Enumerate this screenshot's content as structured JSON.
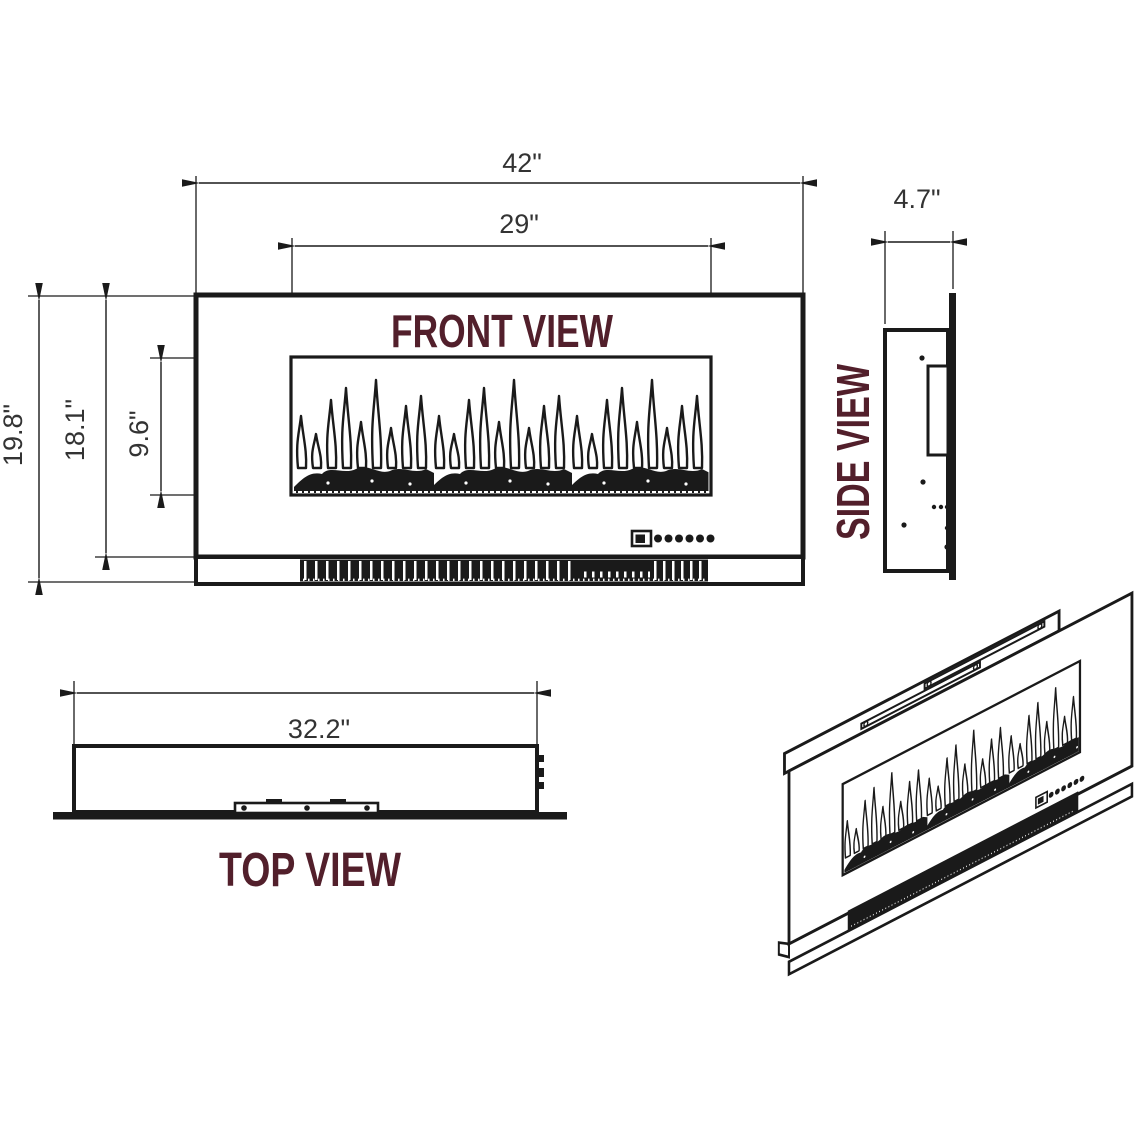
{
  "colors": {
    "title": "#521f2b",
    "line": "#1a1a1a",
    "dim_text": "#333333",
    "background": "#ffffff"
  },
  "views": {
    "front": {
      "label": "FRONT VIEW",
      "dimensions": {
        "overall_width": "42\"",
        "window_width": "29\"",
        "overall_height": "19.8\"",
        "body_height": "18.1\"",
        "window_height": "9.6\""
      }
    },
    "side": {
      "label": "SIDE VIEW",
      "dimensions": {
        "depth": "4.7\""
      }
    },
    "top": {
      "label": "TOP VIEW",
      "dimensions": {
        "mount_width": "32.2\""
      }
    }
  }
}
